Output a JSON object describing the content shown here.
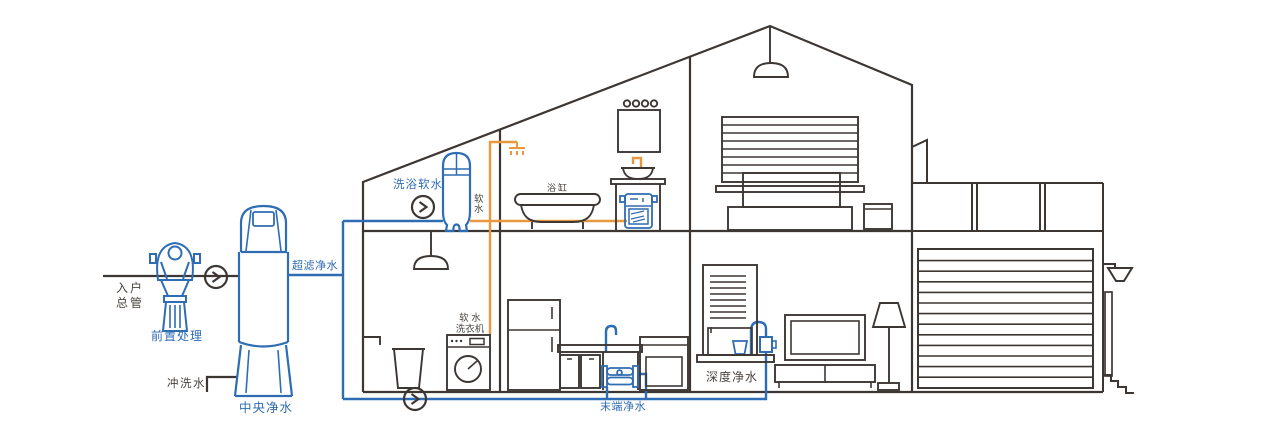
{
  "labels": {
    "entry_main": "入户\n总管",
    "pre_treatment": "前置处理",
    "flush_water": "冲洗水",
    "central_purifier": "中央净水",
    "ultrafiltration": "超滤净水",
    "bath_softener": "洗浴软水",
    "soft_water": "软\n水",
    "bathtub": "浴缸",
    "soft_washer": "软 水\n洗衣机",
    "terminal_purifier": "末端净水",
    "deep_purifier": "深度净水"
  },
  "colors": {
    "line": "#3d3734",
    "text": "#4a443f",
    "blue": "#2e6cb3",
    "orange": "#e8993f",
    "bg": "#ffffff"
  }
}
